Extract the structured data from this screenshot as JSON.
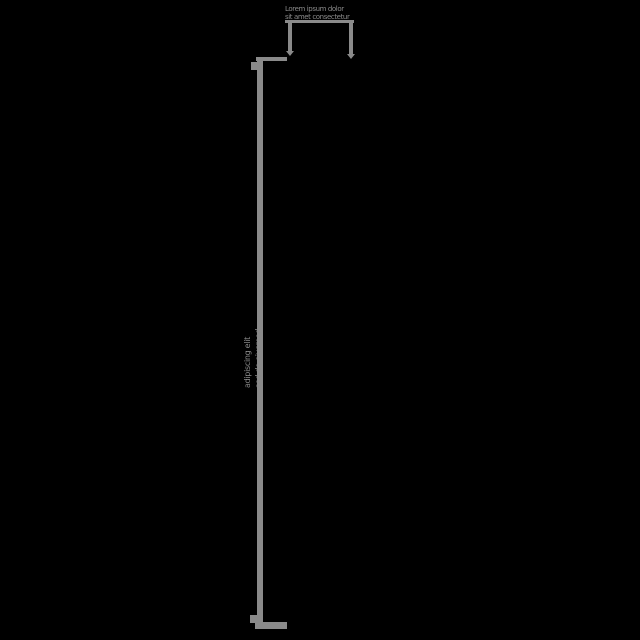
{
  "canvas": {
    "width": 640,
    "height": 640,
    "background": "#000000",
    "ink": "#8a8a8a"
  },
  "top_node": {
    "line1": "Lorem ipsum dolor",
    "line2": "sit amet consectetur"
  },
  "bracket": {
    "label_line1": "adipiscing elit",
    "label_line2": "sed do eiusmod"
  }
}
